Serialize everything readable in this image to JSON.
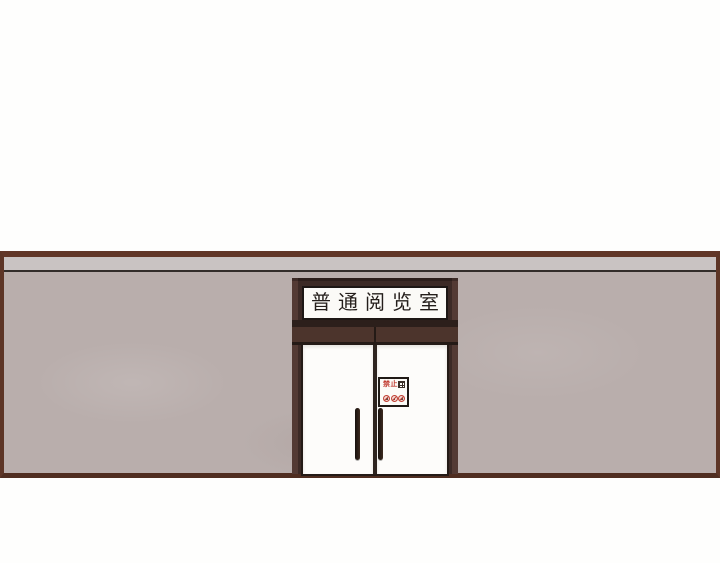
{
  "scene": {
    "wall": {
      "surface_color": "#b9aeac",
      "cornice_color": "#c9c3c2",
      "trim_color": "#5d3526"
    },
    "entrance": {
      "frame_color": "#3c2a26",
      "door_color": "#fcfbf8",
      "nameplate": {
        "text": "普通阅览室",
        "background": "#fbfaf7",
        "text_color": "#241e1b"
      },
      "notice_sign": {
        "heading": "禁止",
        "accent_color": "#c0392e",
        "background": "#fcfbf7",
        "icons": [
          "schedule-grid-icon",
          "prohibition-icon",
          "prohibition-icon",
          "prohibition-icon"
        ]
      }
    }
  }
}
